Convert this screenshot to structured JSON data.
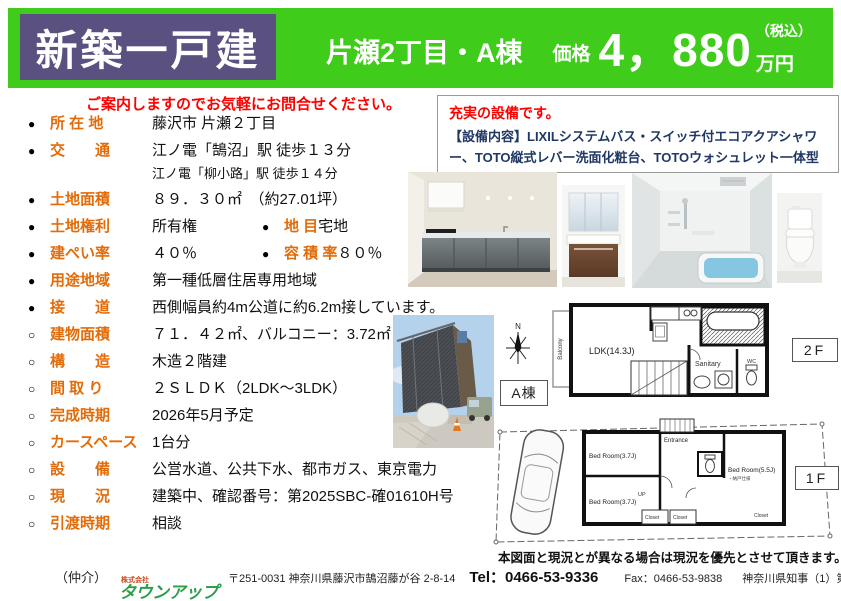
{
  "colors": {
    "banner_green": "#40cc1a",
    "badge_purple": "#5a5180",
    "label_orange": "#e36c0a",
    "notice_red": "#ff0000",
    "equipment_navy": "#1f3864",
    "logo_green": "#2e9e4c"
  },
  "banner": {
    "badge": "新築一戸建",
    "area": "片瀬2丁目・A棟",
    "price_label": "価格",
    "price": "4，880",
    "tax": "（税込）",
    "unit": "万円"
  },
  "notice": "ご案内しますのでお気軽にお問合せください。",
  "details": {
    "rows": [
      {
        "pairs": [
          {
            "bullet": "●",
            "label": "所 在 地",
            "value": "藤沢市 片瀬２丁目"
          }
        ]
      },
      {
        "pairs": [
          {
            "bullet": "●",
            "label": "交　　通",
            "value": "江ノ電「鵠沼」駅  徒歩１３分"
          }
        ],
        "sub": "江ノ電「柳小路」駅  徒歩１４分"
      },
      {
        "pairs": [
          {
            "bullet": "●",
            "label": "土地面積",
            "value": "８９．３０㎡　（約27.01坪）"
          }
        ]
      },
      {
        "pairs": [
          {
            "bullet": "●",
            "label": "土地権利",
            "value": "所有権"
          },
          {
            "bullet": "●",
            "label": "地 目",
            "value": "宅地"
          }
        ]
      },
      {
        "pairs": [
          {
            "bullet": "●",
            "label": "建ぺい率",
            "value": "４０％"
          },
          {
            "bullet": "●",
            "label": "容 積 率",
            "value": "８０％"
          }
        ]
      },
      {
        "pairs": [
          {
            "bullet": "●",
            "label": "用途地域",
            "value": "第一種低層住居専用地域"
          }
        ]
      },
      {
        "pairs": [
          {
            "bullet": "●",
            "label": "接　　道",
            "value": "西側幅員約4m公道に約6.2m接しています。"
          }
        ]
      },
      {
        "pairs": [
          {
            "bullet": "○",
            "label": "建物面積",
            "value": "７１．４２㎡、バルコニー：3.72㎡"
          }
        ]
      },
      {
        "pairs": [
          {
            "bullet": "○",
            "label": "構　　造",
            "value": "木造２階建"
          }
        ]
      },
      {
        "pairs": [
          {
            "bullet": "○",
            "label": "間 取 り",
            "value": "２ＳＬＤＫ（2LDK～3LDK）"
          }
        ]
      },
      {
        "pairs": [
          {
            "bullet": "○",
            "label": "完成時期",
            "value": "2026年5月予定"
          }
        ]
      },
      {
        "pairs": [
          {
            "bullet": "○",
            "label": "カースペース",
            "value": "1台分"
          }
        ]
      },
      {
        "pairs": [
          {
            "bullet": "○",
            "label": "設　　備",
            "value": "公営水道、公共下水、都市ガス、東京電力"
          }
        ]
      },
      {
        "pairs": [
          {
            "bullet": "○",
            "label": "現　　況",
            "value": "建築中、確認番号：第2025SBC-確01610H号"
          }
        ]
      },
      {
        "pairs": [
          {
            "bullet": "○",
            "label": "引渡時期",
            "value": "相談"
          }
        ]
      }
    ]
  },
  "equipment": {
    "title": "充実の設備です。",
    "body": "【設備内容】LIXILシステムバス・スイッチ付エコアクアシャワー、TOTO縦式レバー洗面化粧台、TOTOウォシュレット一体型トイレ等"
  },
  "plans": {
    "building": "A棟",
    "compass": "N",
    "f2": {
      "label": "2F",
      "balcony": "Balcony",
      "ldk": "LDK(14.3J)",
      "sanitary": "Sanitary",
      "wc": "WC"
    },
    "f1": {
      "label": "1F",
      "bed1": "Bed Room(3.7J)",
      "bed2": "Bed Room(3.7J)",
      "bed3": "Bed Room(5.5J)",
      "bed3_note": "・納戸仕様",
      "entrance": "Entrance",
      "closet1": "Closet",
      "closet2": "Closet",
      "closet3": "Closet",
      "up": "UP"
    },
    "disclaimer": "本図面と現況とが異なる場合は現況を優先とさせて頂きます。"
  },
  "footer": {
    "broker": "（仲介）",
    "company_small": "株式会社",
    "company": "タウンアップ",
    "address": "〒251-0031 神奈川県藤沢市鵠沼藤が谷 2-8-14",
    "tel": "Tel：0466-53-9336",
    "fax": "Fax：0466-53-9838",
    "license": "神奈川県知事（1）第31982号"
  }
}
